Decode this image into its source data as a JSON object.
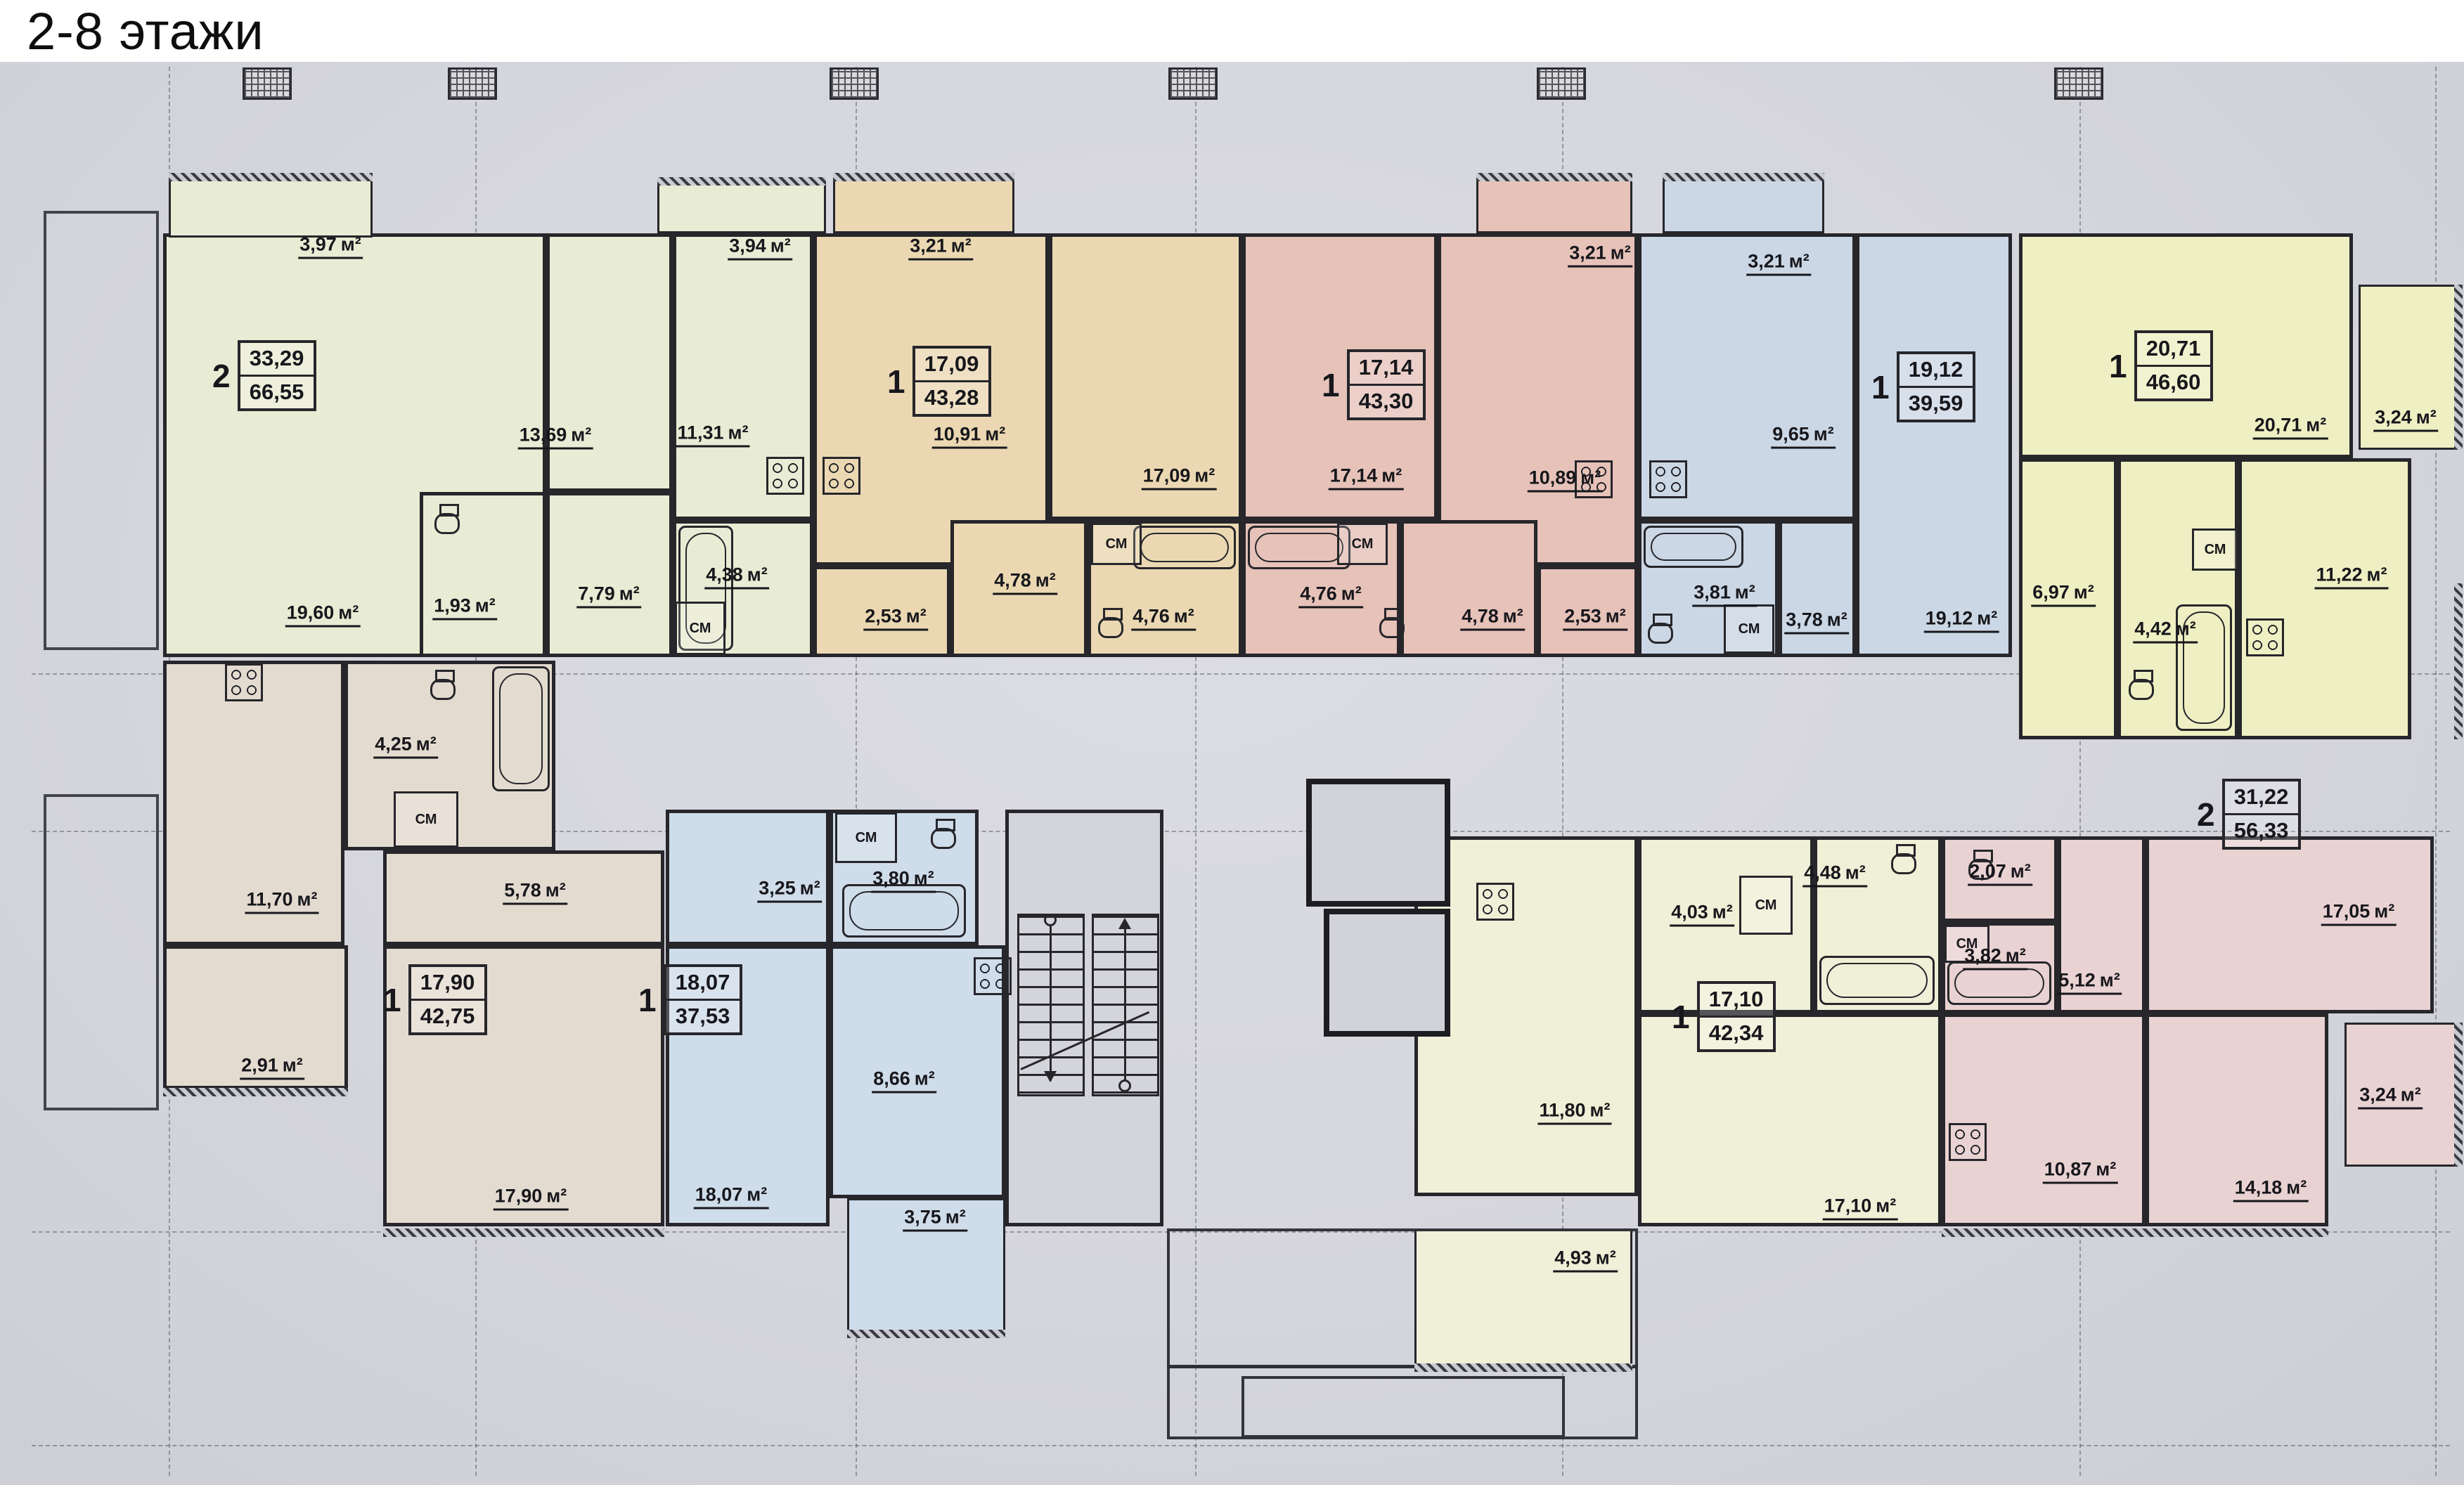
{
  "title": "2-8 этажи",
  "unit": "м²",
  "closet_label": "СМ",
  "colors": {
    "paper": "#d5d6dc",
    "walls": "#26262b",
    "apt_a": "#e9ecd4",
    "apt_b": "#ebd8b2",
    "apt_c": "#e6c2b9",
    "apt_d": "#cbd7e5",
    "apt_e": "#eef0c3",
    "apt_f": "#e9d2d2",
    "apt_g": "#f0efd7",
    "apt_h": "#cfdcea",
    "apt_i": "#e4dbd0"
  },
  "apartments": [
    {
      "id": "top-left-2k",
      "rooms_count": "2",
      "living_area": "33,29",
      "total_area": "66,55",
      "color": "#e9ecd4",
      "rooms": {
        "living": "19,60",
        "bedroom": "13,69",
        "kitchen": "11,31",
        "hall": "7,79",
        "bath": "4,38",
        "wc": "1,93",
        "balcony1": "3,97",
        "balcony2": "3,94"
      }
    },
    {
      "id": "top-1k-tan",
      "rooms_count": "1",
      "living_area": "17,09",
      "total_area": "43,28",
      "color": "#ebd8b2",
      "rooms": {
        "living": "17,09",
        "kitchen": "10,91",
        "hall": "4,78",
        "bath": "4,76",
        "wardrobe": "2,53",
        "balcony": "3,21"
      }
    },
    {
      "id": "top-1k-pink",
      "rooms_count": "1",
      "living_area": "17,14",
      "total_area": "43,30",
      "color": "#e6c2b9",
      "rooms": {
        "living": "17,14",
        "kitchen": "10,89",
        "hall": "4,78",
        "bath": "4,76",
        "wardrobe": "2,53",
        "balcony": "3,21"
      }
    },
    {
      "id": "top-1k-blue",
      "rooms_count": "1",
      "living_area": "19,12",
      "total_area": "39,59",
      "color": "#cbd7e5",
      "rooms": {
        "living": "19,12",
        "kitchen": "9,65",
        "bath": "3,81",
        "hall": "3,78",
        "balcony": "3,21"
      }
    },
    {
      "id": "top-right-1k",
      "rooms_count": "1",
      "living_area": "20,71",
      "total_area": "46,60",
      "color": "#eef0c3",
      "rooms": {
        "living": "20,71",
        "kitchen": "11,22",
        "hall": "6,97",
        "bath": "4,42",
        "balcony": "3,24"
      }
    },
    {
      "id": "bottom-right-2k",
      "rooms_count": "2",
      "living_area": "31,22",
      "total_area": "56,33",
      "color": "#e9d2d2",
      "rooms": {
        "room": "17,05",
        "living": "14,18",
        "kitchen": "10,87",
        "hall": "5,12",
        "bath": "3,82",
        "wc": "2,07",
        "balcony": "3,24"
      }
    },
    {
      "id": "bottom-1k-yellow",
      "rooms_count": "1",
      "living_area": "17,10",
      "total_area": "42,34",
      "color": "#f0efd7",
      "rooms": {
        "living": "17,10",
        "kitchen": "11,80",
        "bath": "4,48",
        "hall": "4,03",
        "balcony": "4,93"
      }
    },
    {
      "id": "bottom-1k-blue",
      "rooms_count": "1",
      "living_area": "18,07",
      "total_area": "37,53",
      "color": "#cfdcea",
      "rooms": {
        "living": "18,07",
        "kitchen": "8,66",
        "bath": "3,80",
        "hall": "3,25",
        "balcony": "3,75"
      }
    },
    {
      "id": "bottom-left-1k",
      "rooms_count": "1",
      "living_area": "17,90",
      "total_area": "42,75",
      "color": "#e4dbd0",
      "rooms": {
        "living": "17,90",
        "kitchen": "11,70",
        "hall": "5,78",
        "bath": "4,25",
        "storage": "2,91"
      }
    }
  ]
}
